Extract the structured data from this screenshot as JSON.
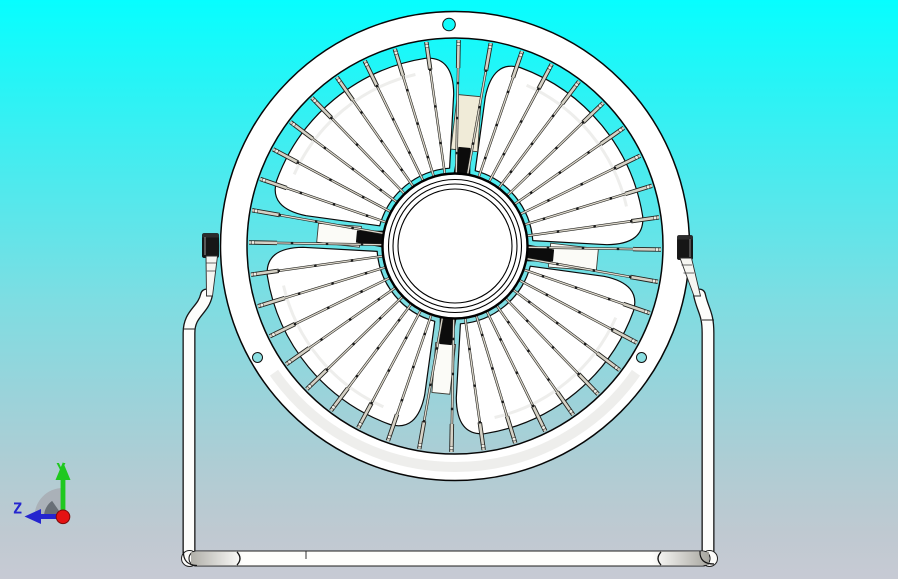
{
  "viewport": {
    "type_hint": "3D CAD viewport, front orthographic view",
    "background_top_color": "#06FEFF",
    "background_bottom_color": "#C7CAD4"
  },
  "model": {
    "subject": "desk fan with circular wire guard, four petal blades and tubular stand",
    "blade_count": 4,
    "spoke_count": 40,
    "rim_hole_count": 3,
    "colors": {
      "body_white": "#FFFFFF",
      "outline": "#0A0A0A",
      "wire_light": "#DDD8CC",
      "wire_dark": "#23231F",
      "tip_light": "#D6D2C6",
      "blade_root_black": "#0C0C0C",
      "motor_strut_beige": "#F0EBD8",
      "strut_white": "#FBFBF7",
      "knob_black": "#161616",
      "hole_cyan_top": "#12FBFB",
      "hole_cyan_side": "#8ADFE2"
    }
  },
  "stand": {
    "tube_color": "#FDFDFB",
    "tube_outline": "#1A1A1A"
  },
  "triad": {
    "y_label": "Y",
    "z_label": "Z",
    "y_color": "#1FC81F",
    "z_color": "#2525CF",
    "origin_color": "#E51212",
    "disc_light_color": "#A9AEB5",
    "disc_dark_color": "#646B72"
  }
}
